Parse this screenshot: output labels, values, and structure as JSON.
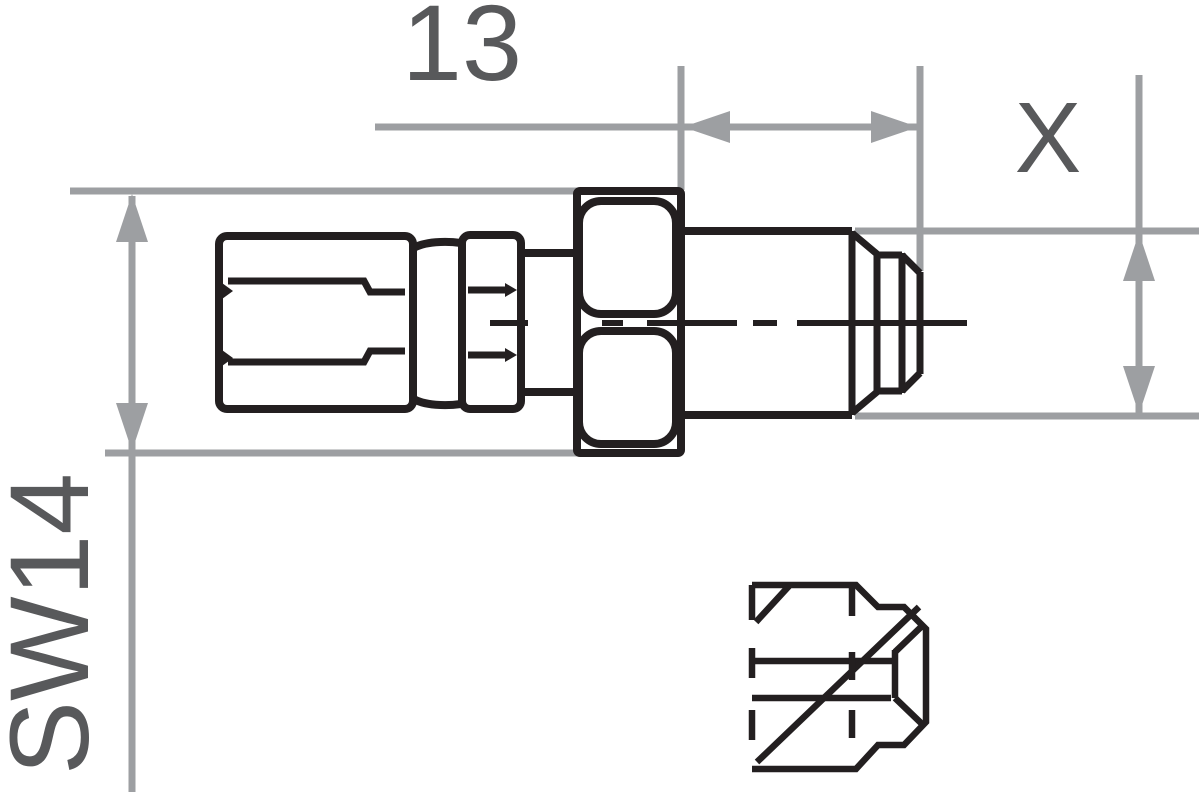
{
  "drawing": {
    "type": "technical-drawing",
    "labels": {
      "length_dimension": "13",
      "thread_dimension": "X",
      "wrench_dimension": "SW14"
    },
    "colors": {
      "line_black": "#231f20",
      "dimension_gray": "#9d9fa2",
      "text_gray": "#58595b",
      "background": "#ffffff"
    }
  }
}
